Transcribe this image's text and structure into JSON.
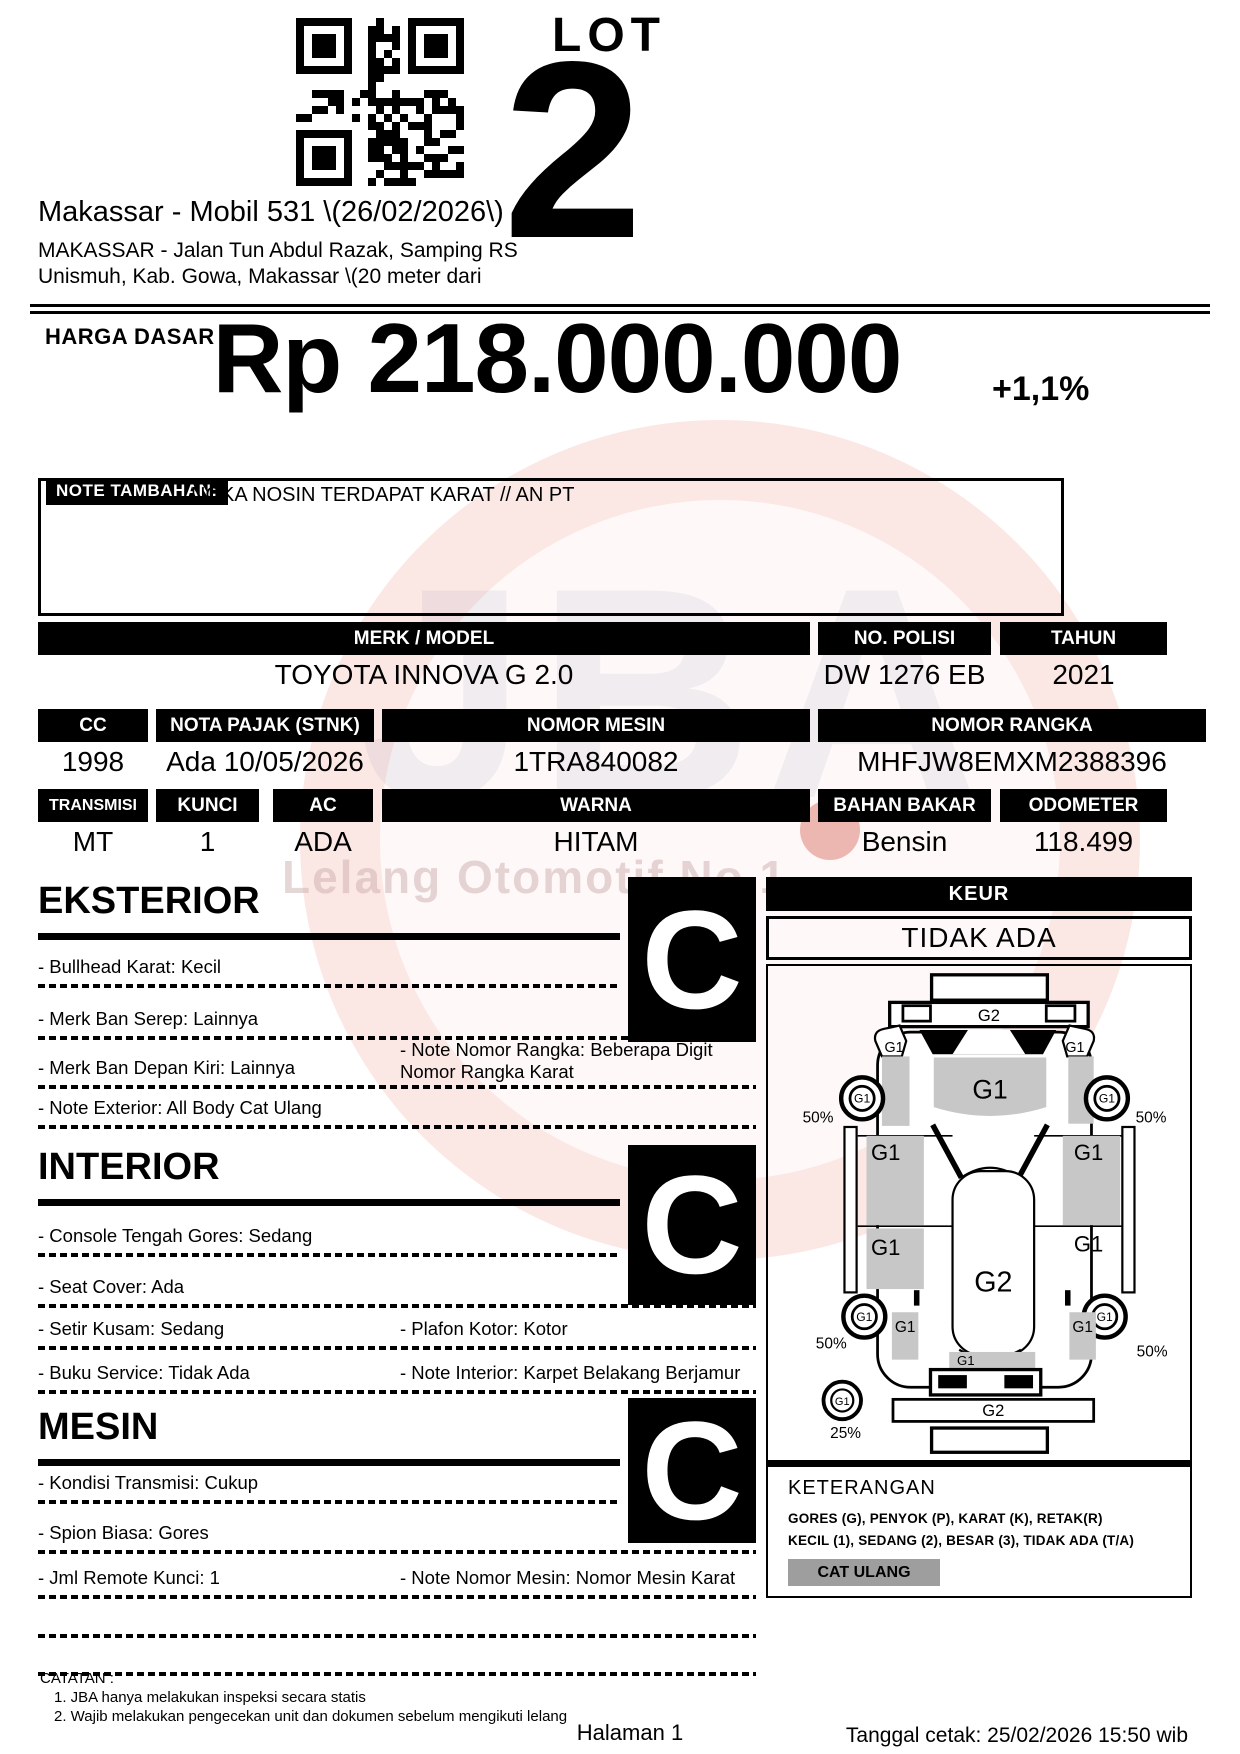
{
  "lot": {
    "label": "LOT",
    "number": "2"
  },
  "header": {
    "title": "Makassar - Mobil 531 \\(26/02/2026\\)",
    "address_line1": "MAKASSAR - Jalan Tun Abdul Razak, Samping RS",
    "address_line2": "Unismuh, Kab. Gowa, Makassar \\(20 meter dari"
  },
  "price": {
    "label": "HARGA DASAR :",
    "value": "Rp 218.000.000",
    "change": "+1,1%"
  },
  "note": {
    "label": "NOTE TAMBAHAN:",
    "text": "NOKA NOSIN TERDAPAT KARAT // AN PT"
  },
  "vehicle": {
    "merk_model": {
      "label": "MERK / MODEL",
      "value": "TOYOTA INNOVA G 2.0"
    },
    "no_polisi": {
      "label": "NO. POLISI",
      "value": "DW 1276 EB"
    },
    "tahun": {
      "label": "TAHUN",
      "value": "2021"
    },
    "cc": {
      "label": "CC",
      "value": "1998"
    },
    "nota_pajak": {
      "label": "NOTA PAJAK (STNK)",
      "value": "Ada 10/05/2026"
    },
    "nomor_mesin": {
      "label": "NOMOR MESIN",
      "value": "1TRA840082"
    },
    "nomor_rangka": {
      "label": "NOMOR RANGKA",
      "value": "MHFJW8EMXM2388396"
    },
    "transmisi": {
      "label": "TRANSMISI",
      "value": "MT"
    },
    "kunci": {
      "label": "KUNCI",
      "value": "1"
    },
    "ac": {
      "label": "AC",
      "value": "ADA"
    },
    "warna": {
      "label": "WARNA",
      "value": "HITAM"
    },
    "bahan_bakar": {
      "label": "BAHAN BAKAR",
      "value": "Bensin"
    },
    "odometer": {
      "label": "ODOMETER",
      "value": "118.499"
    }
  },
  "sections": {
    "eksterior": {
      "title": "EKSTERIOR",
      "grade": "C",
      "rows": [
        {
          "l": "- Bullhead Karat: Kecil",
          "r": ""
        },
        {
          "l": "- Merk Ban Serep: Lainnya",
          "r": ""
        },
        {
          "l": "- Merk Ban Depan Kiri: Lainnya",
          "r": "- Note Nomor Rangka: Beberapa Digit Nomor Rangka Karat"
        },
        {
          "l": "- Note Exterior: All Body Cat Ulang",
          "r": ""
        }
      ]
    },
    "interior": {
      "title": "INTERIOR",
      "grade": "C",
      "rows": [
        {
          "l": "- Console Tengah Gores: Sedang",
          "r": ""
        },
        {
          "l": "- Seat Cover: Ada",
          "r": ""
        },
        {
          "l": "- Setir Kusam: Sedang",
          "r": "- Plafon Kotor: Kotor"
        },
        {
          "l": "- Buku Service: Tidak Ada",
          "r": "- Note Interior: Karpet Belakang Berjamur"
        }
      ]
    },
    "mesin": {
      "title": "MESIN",
      "grade": "C",
      "rows": [
        {
          "l": "- Kondisi Transmisi: Cukup",
          "r": ""
        },
        {
          "l": "- Spion Biasa: Gores",
          "r": ""
        },
        {
          "l": "- Jml Remote Kunci: 1",
          "r": "- Note Nomor Mesin: Nomor Mesin Karat"
        },
        {
          "l": "",
          "r": ""
        },
        {
          "l": "",
          "r": ""
        }
      ]
    }
  },
  "keur": {
    "label": "KEUR",
    "value": "TIDAK ADA"
  },
  "diagram": {
    "g1": "G1",
    "g2": "G2",
    "pct50": "50%",
    "pct25": "25%"
  },
  "keterangan": {
    "title": "KETERANGAN",
    "line1": "GORES (G), PENYOK (P), KARAT (K), RETAK(R)",
    "line2": "KECIL (1), SEDANG (2), BESAR (3), TIDAK ADA (T/A)",
    "badge": "CAT ULANG"
  },
  "watermark": {
    "text": "Lelang Otomotif No.1"
  },
  "footer": {
    "catatan_title": "CATATAN :",
    "note1": "1. JBA hanya melakukan inspeksi secara statis",
    "note2": "2. Wajib melakukan pengecekan unit dan dokumen sebelum mengikuti lelang",
    "page": "Halaman 1",
    "printed": "Tanggal cetak: 25/02/2026 15:50 wib"
  }
}
